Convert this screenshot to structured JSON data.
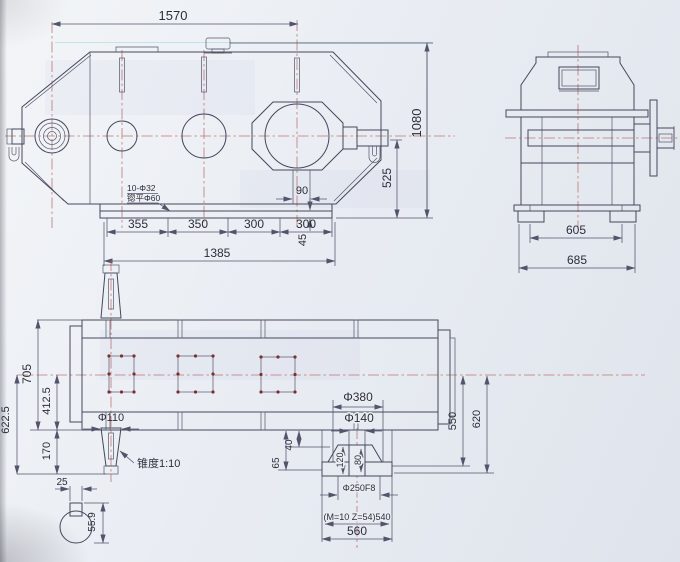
{
  "document": {
    "type": "engineering-drawing",
    "subject": "gear reducer three-view technical drawing"
  },
  "front": {
    "dim_span": "1570",
    "dim_height": "1080",
    "dim_axis_height": "525",
    "dim_rib": "90",
    "dim_base_plate": "45",
    "feet": [
      "355",
      "350",
      "300",
      "300"
    ],
    "dim_base": "1385",
    "hole_note_1": "10-Φ32",
    "hole_note_2": "锪平Φ60"
  },
  "side": {
    "dim_inner": "605",
    "dim_outer": "685"
  },
  "plan": {
    "dim_width": "705",
    "dim_half": "412.5",
    "dim_shaft_end": "622.5",
    "dim_shaft_len": "170",
    "dim_shaft_dia": "Φ110",
    "taper_note": "锥度1:10",
    "key_width": "25",
    "key_height": "55.9",
    "dim_flange": "Φ380",
    "dim_bore": "Φ140",
    "dim_40": "40",
    "dim_65": "65",
    "dim_hub_120": "120",
    "dim_hub_80": "80",
    "dim_spigot": "Φ250F8",
    "gear_note": "(M=10 Z=54)540",
    "dim_coupling": "560",
    "dim_550": "550",
    "dim_620": "620"
  },
  "colors": {
    "line": "#46475c",
    "dim": "#53546b",
    "centerline": "#b95f5f",
    "paper": "#e9edf3",
    "text": "#2c2d3a"
  }
}
